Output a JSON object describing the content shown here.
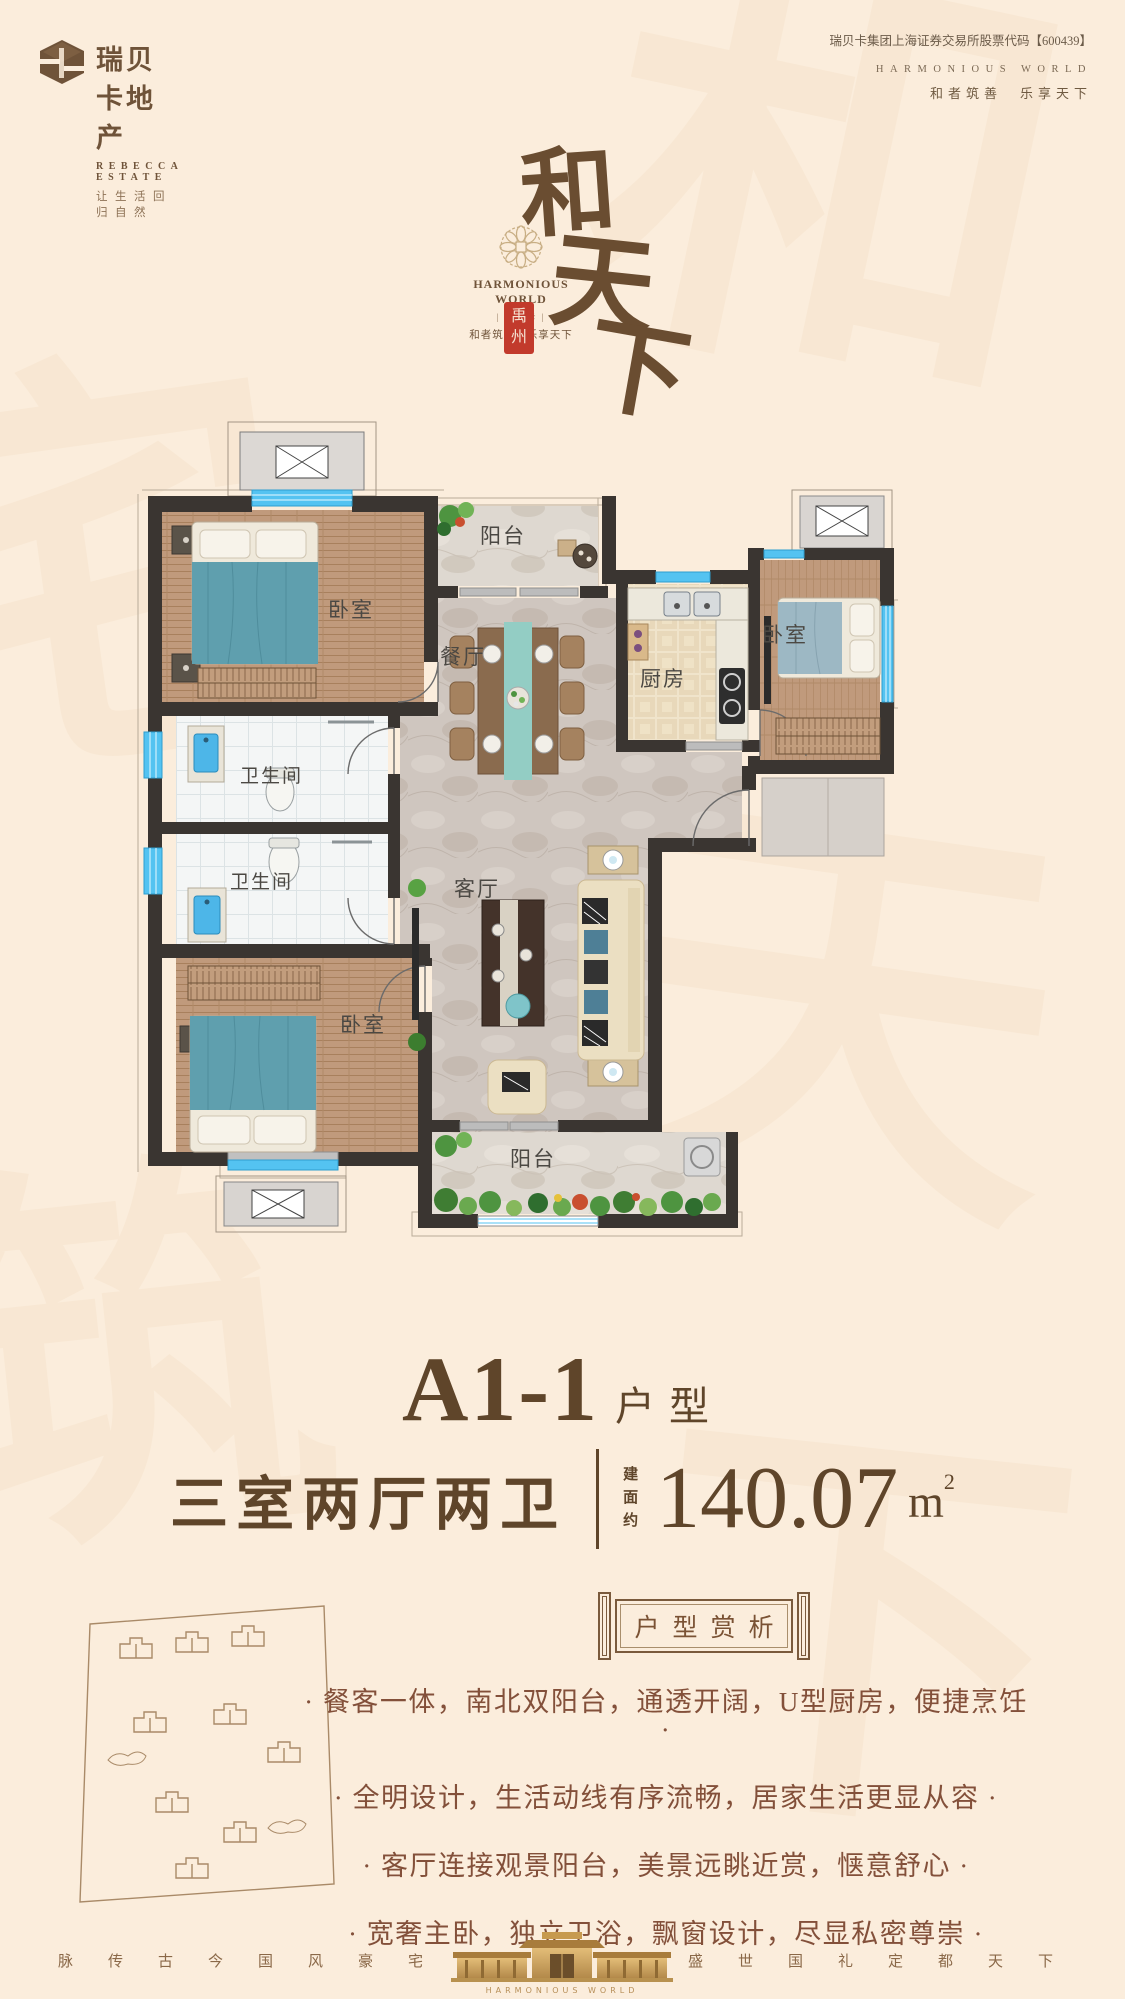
{
  "header": {
    "logo_name": "瑞贝卡地产",
    "logo_en": "REBECCA ESTATE",
    "logo_slogan": "让生活回归自然",
    "stock_line": "瑞贝卡集团上海证券交易所股票代码【600439】",
    "right_en": "HARMONIOUS WORLD",
    "right_cn": "和者筑善　乐享天下"
  },
  "brand": {
    "char1": "和",
    "char2": "天",
    "char3": "下",
    "en": "HARMONIOUS WORLD",
    "mark": "| 瑞贝卡 |",
    "slogan": "和者筑善。乐享天下",
    "seal_char1": "禹",
    "seal_char2": "州",
    "medallion_icon": "rosette"
  },
  "floorplan": {
    "labels": {
      "bedroom_tl": "卧室",
      "balcony_top": "阳台",
      "dining": "餐厅",
      "kitchen": "厨房",
      "bedroom_r": "卧室",
      "bath1": "卫生间",
      "bath2": "卫生间",
      "living": "客厅",
      "bedroom_master": "卧室",
      "balcony_bottom": "阳台"
    }
  },
  "title": {
    "model": "A1-1",
    "model_suffix": "户型",
    "layout": "三室两厅两卫",
    "area_prefix": "建面约",
    "area_value": "140.07",
    "area_unit": "m",
    "area_sup": "2"
  },
  "banner": {
    "text": "户型赏析"
  },
  "features": [
    "· 餐客一体，南北双阳台，通透开阔，U型厨房，便捷烹饪 ·",
    "· 全明设计，生活动线有序流畅，居家生活更显从容 ·",
    "· 客厅连接观景阳台，美景远眺近赏，惬意舒心 ·",
    "· 宽奢主卧，独立卫浴，飘窗设计，尽显私密尊崇 ·"
  ],
  "footer": {
    "left": "脉传古今国风豪宅",
    "right": "盛世国礼定都天下",
    "center_en": "HARMONIOUS WORLD"
  },
  "watermarks": [
    "和",
    "宅",
    "天",
    "筑",
    "下"
  ],
  "colors": {
    "accent_brown": "#6f5339",
    "seal_red": "#c23a2c",
    "window_blue": "#54c3f1",
    "feature_text": "#83503a"
  }
}
